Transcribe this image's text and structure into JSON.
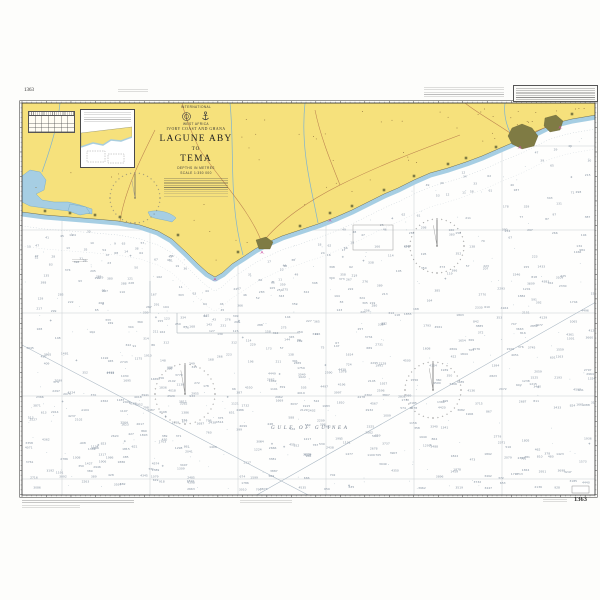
{
  "chart": {
    "number": "1363",
    "title_block": {
      "series": "INTERNATIONAL",
      "region": "WEST AFRICA",
      "countries": "IVORY COAST AND GHANA",
      "title1": "LAGUNE ABY",
      "title2": "TO",
      "title3": "TEMA",
      "depths": "DEPTHS IN METRES",
      "scale": "SCALE 1:350 000"
    },
    "sea_label": "GULF OF GUINEA",
    "colors": {
      "land": "#F6E17C",
      "shallow": "#A6CEE3",
      "coast_stroke": "#6E6E52",
      "sea": "#FEFEFD",
      "city": "#7F7B44",
      "road": "#B4764A",
      "river": "#7FB3D0",
      "frame": "#2F2F2F",
      "graticule": "#C9CED2",
      "contour": "#A8B6C2",
      "sounding": "#8794A3",
      "dot": "#9FB0BC",
      "light": "#C94FA0",
      "village": "#8A6C3C"
    },
    "frame": {
      "x": 22,
      "y": 103,
      "w": 573,
      "h": 392,
      "outer": 2.3
    },
    "coastline": [
      [
        22,
        212
      ],
      [
        45,
        215
      ],
      [
        70,
        217
      ],
      [
        95,
        219
      ],
      [
        118,
        221
      ],
      [
        140,
        225
      ],
      [
        158,
        231
      ],
      [
        172,
        239
      ],
      [
        186,
        252
      ],
      [
        198,
        264
      ],
      [
        208,
        273
      ],
      [
        215,
        277
      ],
      [
        222,
        273
      ],
      [
        232,
        264
      ],
      [
        243,
        257
      ],
      [
        255,
        249
      ],
      [
        266,
        243
      ],
      [
        282,
        236
      ],
      [
        300,
        230
      ],
      [
        318,
        224
      ],
      [
        336,
        217
      ],
      [
        352,
        210
      ],
      [
        368,
        202
      ],
      [
        384,
        194
      ],
      [
        398,
        188
      ],
      [
        414,
        180
      ],
      [
        430,
        173
      ],
      [
        448,
        168
      ],
      [
        466,
        162
      ],
      [
        482,
        156
      ],
      [
        498,
        149
      ],
      [
        512,
        143
      ],
      [
        524,
        138
      ],
      [
        536,
        132
      ],
      [
        548,
        126
      ],
      [
        560,
        122
      ],
      [
        572,
        119
      ],
      [
        584,
        117
      ],
      [
        596,
        115
      ]
    ],
    "graticule": {
      "vertical_x": [
        62,
        150,
        238,
        326,
        414,
        502
      ],
      "horizontal_y": [
        146,
        230,
        313,
        396,
        479
      ]
    },
    "compass_roses": [
      {
        "cx": 135,
        "cy": 198,
        "r": 25
      },
      {
        "cx": 437,
        "cy": 246,
        "r": 27
      },
      {
        "cx": 185,
        "cy": 394,
        "r": 30
      },
      {
        "cx": 433,
        "cy": 390,
        "r": 28
      }
    ],
    "lagoons": [
      "M22,176 L30,170 L40,172 L46,180 L44,190 L36,194 L42,200 L54,202 L68,202 L80,205 L92,209 L92,214 L78,212 L60,210 L44,208 L30,206 L22,202 Z",
      "M70,204 L86,207 L90,213 L80,215 L68,211 Z",
      "M148,212 C158,209 170,212 176,218 L172,222 C162,219 154,219 150,216 Z"
    ],
    "rivers": [
      "M60,103 C58,125 50,150 42,172",
      "M230,103 C235,150 228,200 243,255",
      "M305,103 C300,150 312,190 318,223",
      "M505,103 C503,118 508,130 514,140"
    ],
    "roads": [
      "M262,243 C250,210 220,180 200,150 C190,130 185,115 182,103",
      "M262,243 C280,220 310,200 340,185 C380,165 420,150 460,135",
      "M520,140 C500,125 480,115 465,103",
      "M520,140 C530,132 545,128 556,124",
      "M120,221 C125,190 140,160 155,130",
      "M340,185 C330,160 320,135 315,110"
    ],
    "cities": [
      {
        "points": "512,128 522,124 532,128 538,136 534,146 522,149 512,144 508,136"
      },
      {
        "points": "545,118 556,115 563,121 560,130 550,132 544,126"
      },
      {
        "points": "256,240 266,237 273,242 270,249 259,249"
      }
    ],
    "town_squares": [
      [
        300,
        226
      ],
      [
        330,
        213
      ],
      [
        352,
        206
      ],
      [
        384,
        190
      ],
      [
        414,
        176
      ],
      [
        448,
        164
      ],
      [
        466,
        158
      ],
      [
        120,
        217
      ],
      [
        95,
        215
      ],
      [
        70,
        213
      ],
      [
        45,
        211
      ],
      [
        178,
        235
      ],
      [
        496,
        147
      ],
      [
        572,
        114
      ],
      [
        238,
        252
      ]
    ],
    "lights": [
      [
        215,
        279
      ],
      [
        262,
        252
      ],
      [
        330,
        220
      ],
      [
        520,
        147
      ],
      [
        560,
        127
      ]
    ],
    "limit_boxes": [
      {
        "x": 353,
        "y": 225,
        "w": 40,
        "h": 25
      }
    ],
    "se_box": {
      "x": 572,
      "y": 486,
      "w": 17,
      "h": 7
    },
    "limit_lines": "M150,281 L150,313 M177,313 L177,333 L300,333",
    "diagonal_lines": [
      [
        22,
        345,
        310,
        496
      ],
      [
        255,
        496,
        596,
        302
      ]
    ],
    "contour_offsets": [
      14,
      34
    ],
    "soundings": {
      "seed": 42,
      "count": 640,
      "dot_count": 210,
      "cross_count": 26,
      "village_count": 55
    }
  }
}
